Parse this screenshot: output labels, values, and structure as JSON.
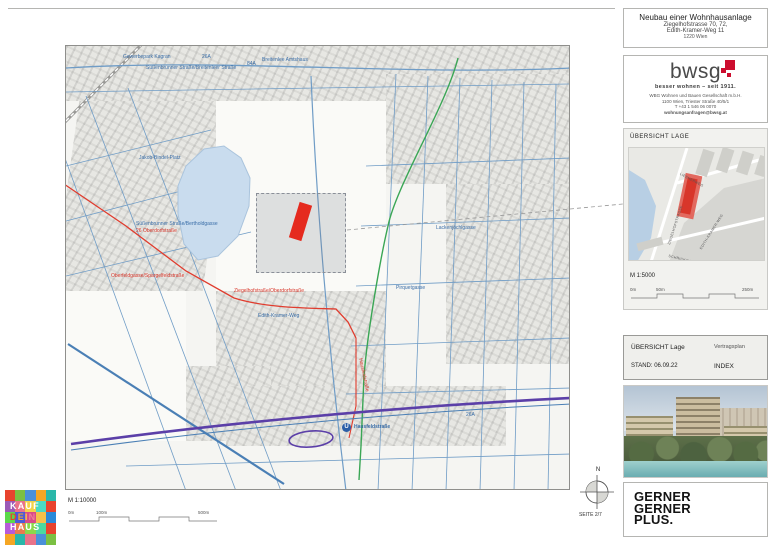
{
  "header": {
    "title": "Neubau einer Wohnhausanlage",
    "address1": "Ziegelhofstrasse 70, 72,",
    "address2": "Edith-Kramer-Weg 11",
    "city": "1220 Wien"
  },
  "bwsg": {
    "logo_text": "bwsg",
    "tagline": "besser wohnen – seit 1911.",
    "company": "WBG Wohnen und Bauen Gesellschaft m.b.H.",
    "address": "1100 Wien, Triester Straße 40/5/1",
    "phone": "T +43 1 546 06 0070",
    "email": "wohnungsanfragen@bwsg.at"
  },
  "overview": {
    "section_title": "ÜBERSICHT LAGE",
    "scale_label": "M 1:5000",
    "scale_ticks": [
      "0m",
      "50m",
      "250m"
    ],
    "minimap_labels": {
      "street1": "ZIEGELHOFSTRASSE",
      "street2": "EDITH-KRAMER-WEG",
      "street3": "LIESNERWEG",
      "street4": "SCHRICKGASSE"
    }
  },
  "titleblock": {
    "row1_left": "ÜBERSICHT Lage",
    "row1_right": "Vertragsplan",
    "row2_left": "STAND: 06.09.22",
    "row2_right": "INDEX"
  },
  "gerner": {
    "line1": "GERNER",
    "line2": "GERNER",
    "line3": "PLUS."
  },
  "compass": {
    "north": "N"
  },
  "page": {
    "label": "SEITE 2/7"
  },
  "map": {
    "scale_label": "M 1:10000",
    "scale_ticks": [
      "0m",
      "100m",
      "500m"
    ],
    "station": {
      "symbol": "U",
      "name": "Hausfeldstraße"
    },
    "labels": [
      {
        "text": "Gewerbepark Kagran",
        "color": "blue"
      },
      {
        "text": "Süßenbrunner Straße/Breitenleer Straße",
        "color": "blue"
      },
      {
        "text": "Breitenlee Amtshaus",
        "color": "blue"
      },
      {
        "text": "26A",
        "color": "blue"
      },
      {
        "text": "84A",
        "color": "blue"
      },
      {
        "text": "Jakob-Bindel-Platz",
        "color": "blue"
      },
      {
        "text": "Süßenbrunner Straße/Bertholdgasse",
        "color": "blue"
      },
      {
        "text": "26 Oberdorfstraße",
        "color": "red"
      },
      {
        "text": "Oberfeldgasse/Spargelfeldstraße",
        "color": "red"
      },
      {
        "text": "Ziegelhofstraße/Oberdorfstraße",
        "color": "red"
      },
      {
        "text": "Edith-Kramer-Weg",
        "color": "blue"
      },
      {
        "text": "Lackenjöchlgasse",
        "color": "blue"
      },
      {
        "text": "Pirquetgasse",
        "color": "blue"
      },
      {
        "text": "Hausfeldstraße",
        "color": "red"
      },
      {
        "text": "26A",
        "color": "blue"
      }
    ]
  },
  "kaufdeinhaus": {
    "line1": "KAUF",
    "dein_letters": [
      "D",
      "E",
      "I",
      "N"
    ],
    "line3": "HAUS"
  },
  "colors": {
    "bwsg_red": "#cc0d2e",
    "parcel_red": "#e52a1e",
    "route_red": "#e03c2e",
    "route_green": "#3aa655",
    "metro_purple": "#5b3fa8",
    "street_blue": "#6f9cc6",
    "water_blue": "#c9dcee"
  }
}
